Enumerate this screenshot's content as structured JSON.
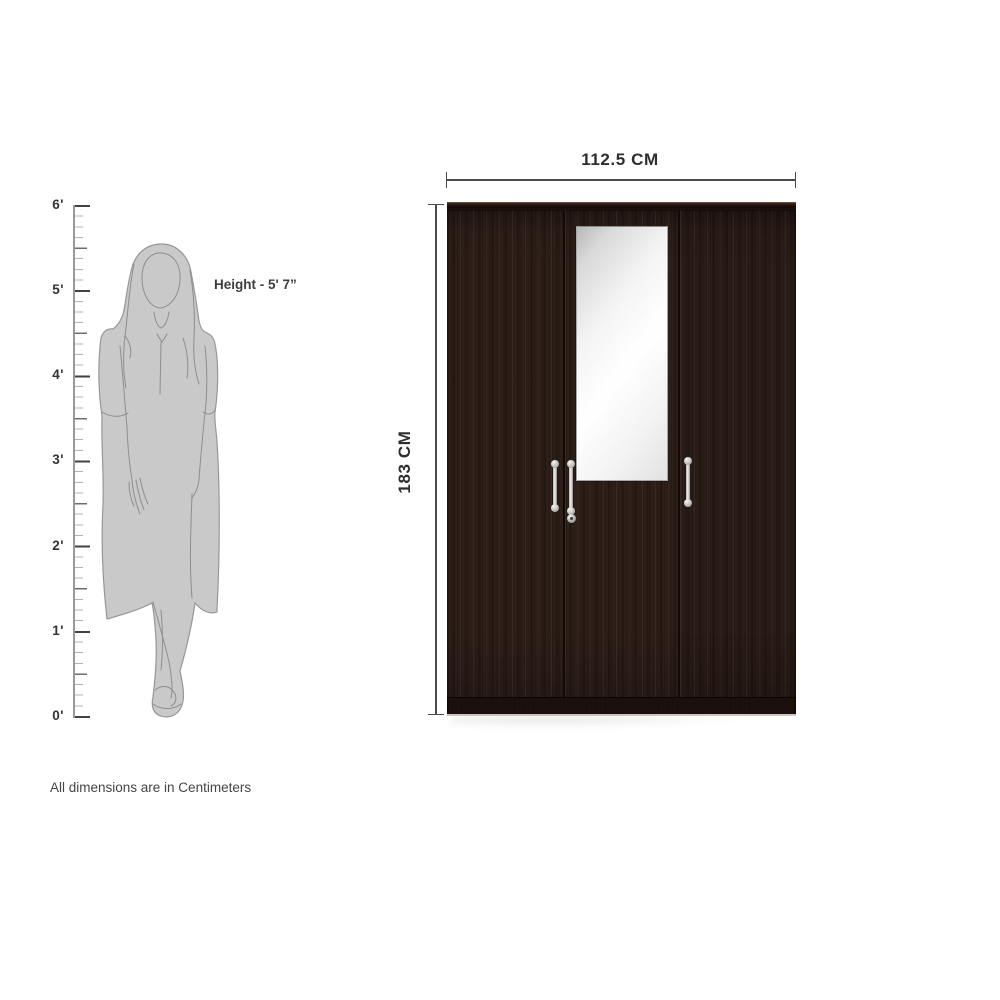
{
  "diagram": {
    "note": "All dimensions are in Centimeters",
    "figure": {
      "height_label": "Height - 5' 7”",
      "ruler_unit": "feet",
      "ruler_labels": [
        "6'",
        "5'",
        "4'",
        "3'",
        "2'",
        "1'",
        "0'"
      ]
    },
    "wardrobe": {
      "width_label": "112.5 CM",
      "height_label": "183 CM",
      "door_count": 3,
      "colors": {
        "wood": "#2f1f19",
        "base_plinth": "#1c100c",
        "handle_silver": "#d9d9d9",
        "mirror": "#f5f5f5",
        "dimension_line": "#4a4a4a"
      }
    }
  }
}
